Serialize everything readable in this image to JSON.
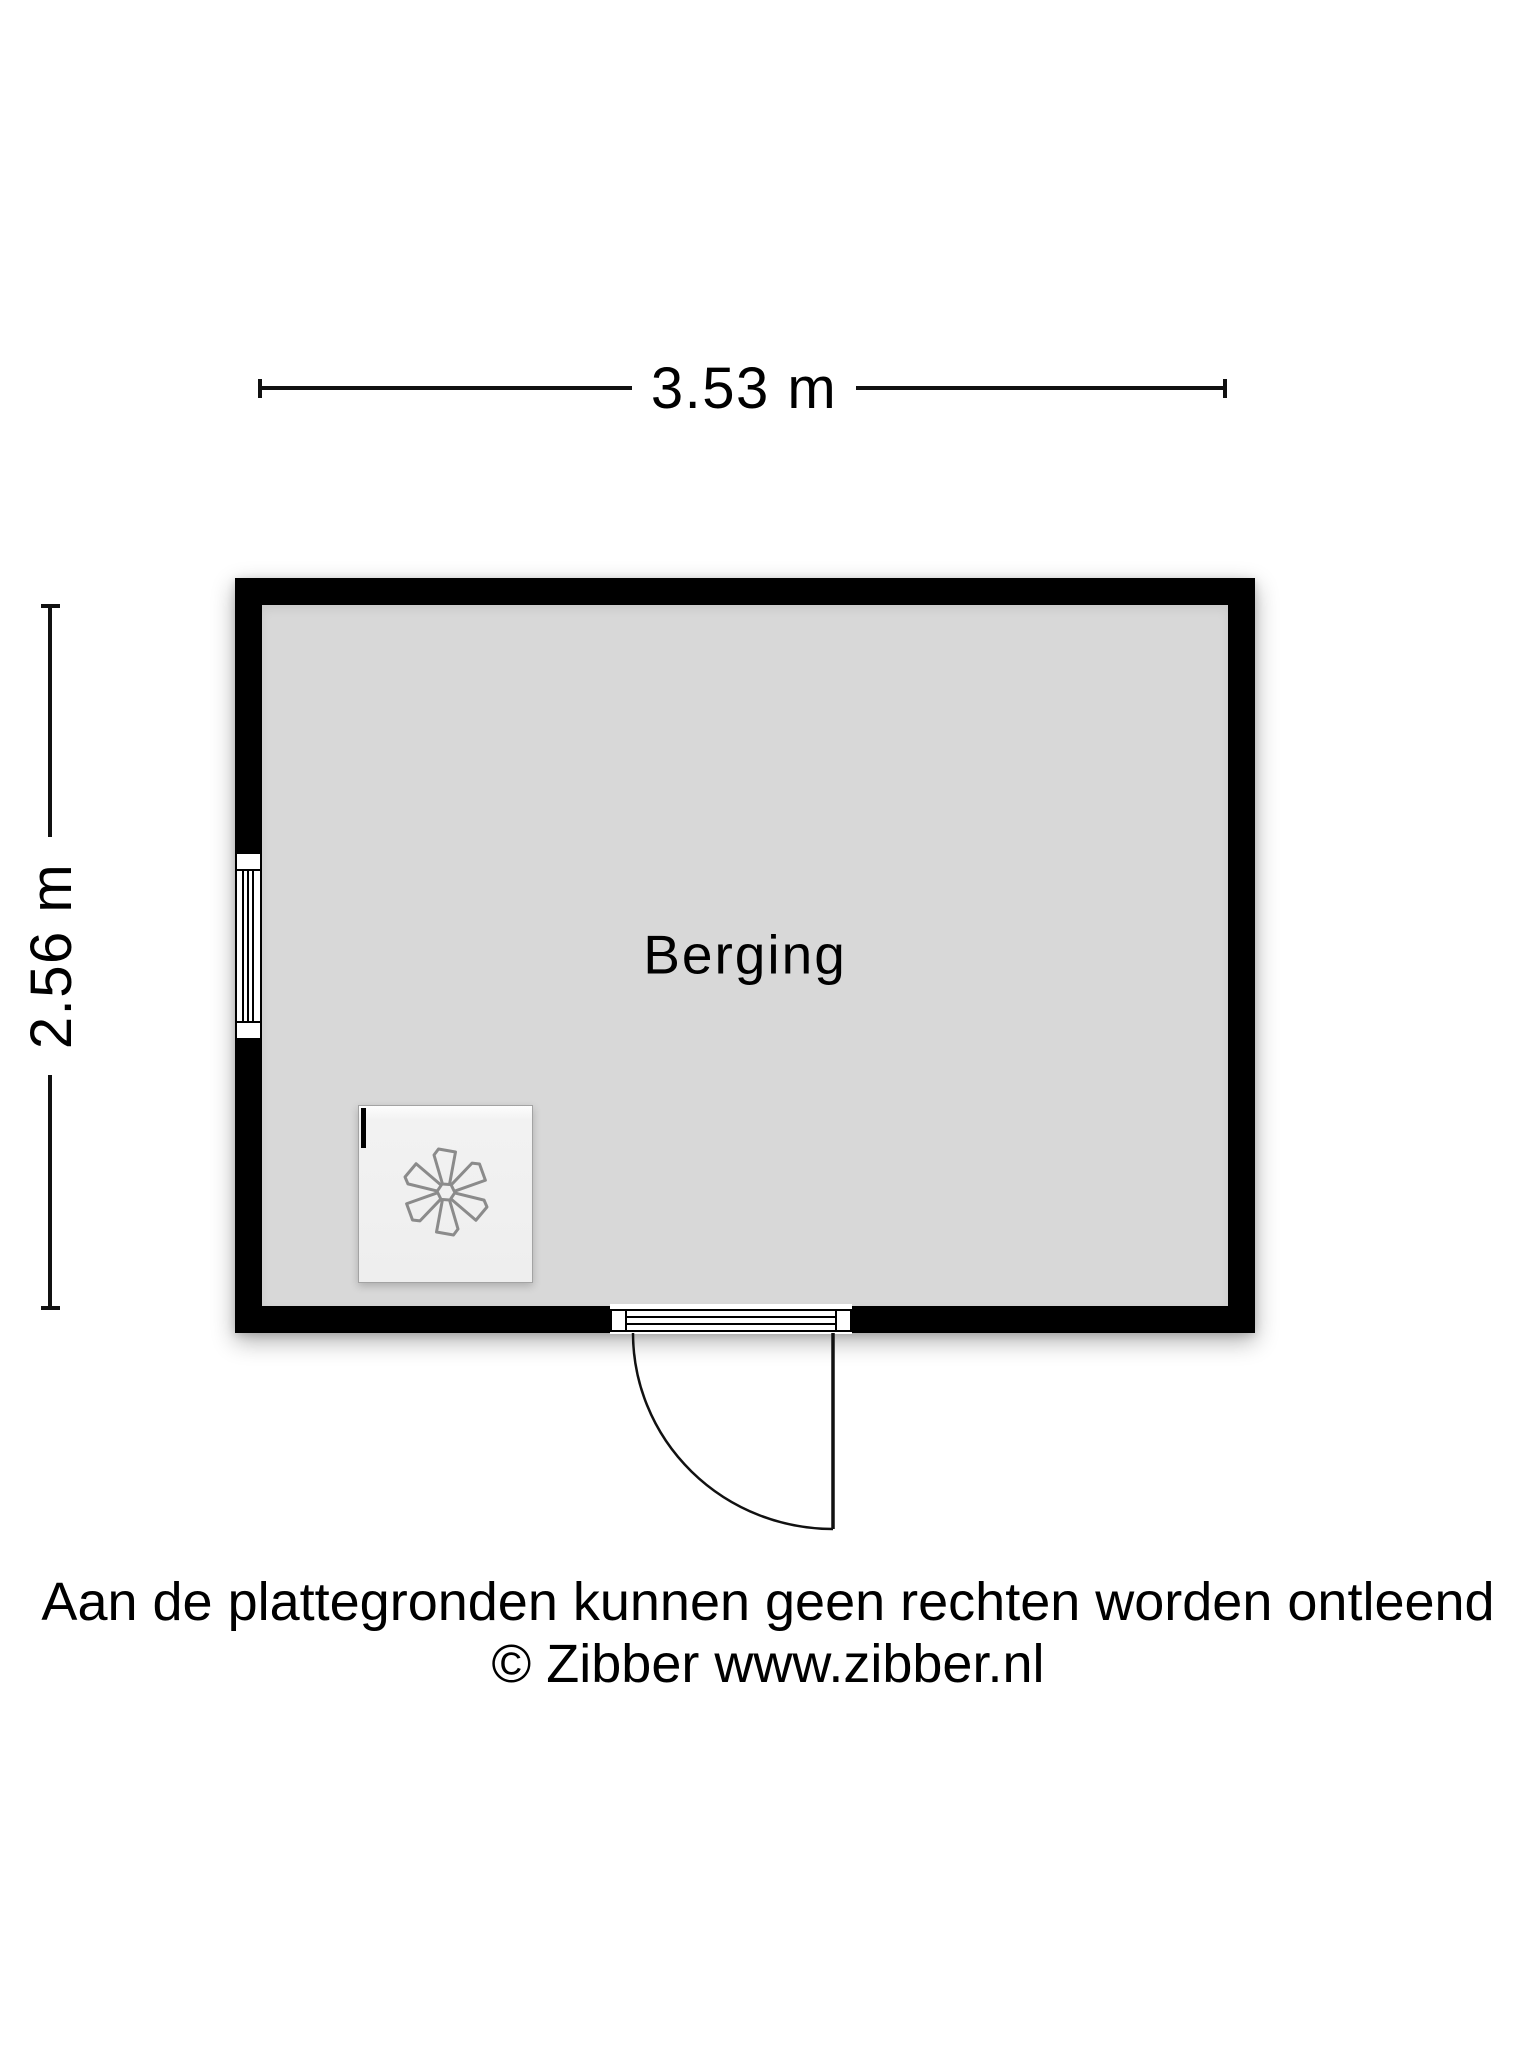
{
  "plan": {
    "room_label": "Berging",
    "width_label": "3.53 m",
    "height_label": "2.56 m",
    "symbols": {
      "window_icon": "triple-line window in left wall",
      "door_icon": "door with quarter-circle swing arc, hinged right, opening outward",
      "fan_icon": "six-blade fan / ventilation unit",
      "connector_mark_icon": "small black wall connector tick"
    },
    "colors": {
      "wall": "#000000",
      "floor": "#d8d8d8",
      "appliance_fill": "#f0f0f0",
      "fan_stroke": "#8b8b8b",
      "background": "#ffffff",
      "text": "#000000"
    }
  },
  "footer": {
    "disclaimer": "Aan de plattegronden kunnen geen rechten worden ontleend",
    "copyright": "© Zibber www.zibber.nl"
  }
}
